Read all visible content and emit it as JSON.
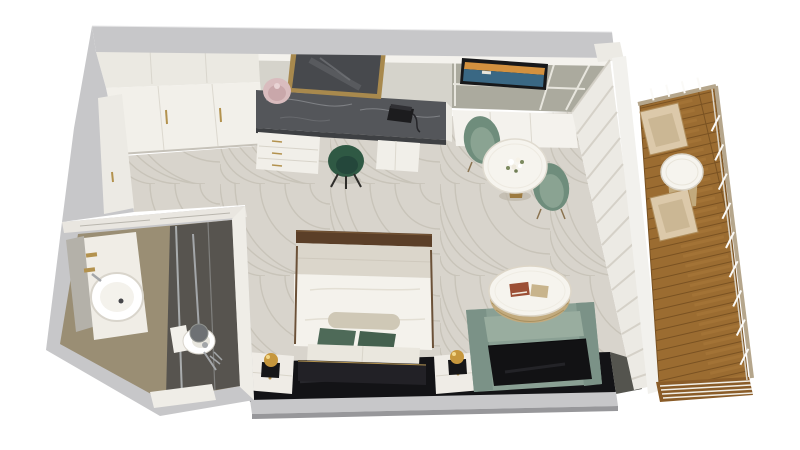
{
  "scene": {
    "title": "3D cutaway floor plan render of a hotel guest room",
    "view": "top-down isometric render on white background",
    "areas": [
      "entry",
      "wardrobe",
      "bathroom",
      "work-desk",
      "media-wall",
      "dining-nook",
      "sleeping-area",
      "lounge",
      "balcony"
    ]
  },
  "furniture": {
    "wardrobe": "white sliding-door wardrobe with brass handles",
    "desk": "gray marble-top vanity desk with white drawers",
    "desk_mirror": "gold framed leaning mirror",
    "desk_lamp": "blush table lamp",
    "telephone": "black telephone",
    "desk_chair": "dark green tub chair",
    "tv": "wall television showing seascape",
    "media_ledge": "white ledge under media wall",
    "dining_table": "round white pedestal table with flowers",
    "dining_chairs": "two sage green armchairs",
    "bed": "double bed, white duvet, green pillows, dark footboard",
    "nightstands": "two white nightstands with brass ball lamps",
    "console": "black full-width headboard console",
    "sofa": "sage settee with black leather seat",
    "coffee_table": "round rattan-base coffee table with books",
    "curtains": "sheer floor-to-ceiling curtains",
    "balcony_chairs": "two folding timber deck chairs",
    "balcony_table": "round white-top side table",
    "basin": "round countertop basin on white vanity",
    "toilet": "white toilet",
    "shower": "walk-in shower with rain head and glass panel"
  },
  "palette": {
    "bg": "#ffffff",
    "wallOuter": "#c7c7c9",
    "wallEdge": "#97979a",
    "wallFace": "#eceae4",
    "ledgeWhite": "#f4f2ed",
    "deskWall": "#d5d3cb",
    "sageWall": "#abaa9e",
    "trim": "#e7e5dd",
    "closetUpper": "#ebe9e2",
    "closetWhite": "#f2f0ea",
    "gold": "#b3924e",
    "marbleDesk": "#54565a",
    "marbleVein": "#8a8c90",
    "mirrorGlass": "#47494d",
    "lampBlush": "#d9bcbe",
    "drawerWhite": "#f1efe9",
    "chairForest": "#2f5944",
    "chairSage": "#6f8d7c",
    "chairSageLight": "#8aa392",
    "tableWhite": "#f6f4ee",
    "tvBlack": "#17181a",
    "tvSky": "#d3913f",
    "tvSea": "#3a6884",
    "carpet": "#d8d4cc",
    "carpetSwirl": "#bcb6aa",
    "curtain": "#eceae4",
    "curtainFold": "#d3cfc5",
    "consoleBlack": "#131316",
    "bedWhite": "#f4f2ec",
    "bedGreige": "#dbd6cb",
    "footboardBrown": "#5b3f28",
    "bolster": "#cfc8b6",
    "pillowGreen": "#4e6a58",
    "pillowGreenDark": "#44604e",
    "pillowWhite": "#eae7de",
    "headboard": "#222126",
    "nightstand": "#efece6",
    "lampGold": "#c6973d",
    "sofaGreen": "#8aa094",
    "sofaGreenDark": "#7b9287",
    "sofaBack": "#99ad9f",
    "sofaSeat": "#121214",
    "rattan": "#c2aa7d",
    "bookRed": "#9c4f35",
    "bookTan": "#c8b48c",
    "woodDeck": "#9b6c31",
    "woodDark": "#7a5222",
    "woodLight": "#b0813f",
    "deckEdge": "#8a5c28",
    "railTan": "#b5a68c",
    "post": "#fbfaf7",
    "mullion": "#f2f1ed",
    "bathWallMarble": "#e9e6e0",
    "bathFloorTan": "#9a8e74",
    "bathShower": "#57544f",
    "glass": "#ccd2d6",
    "porcelain": "#ffffff",
    "chrome": "#a3a6a9",
    "mirrorPanel": "#b4b1a9"
  }
}
